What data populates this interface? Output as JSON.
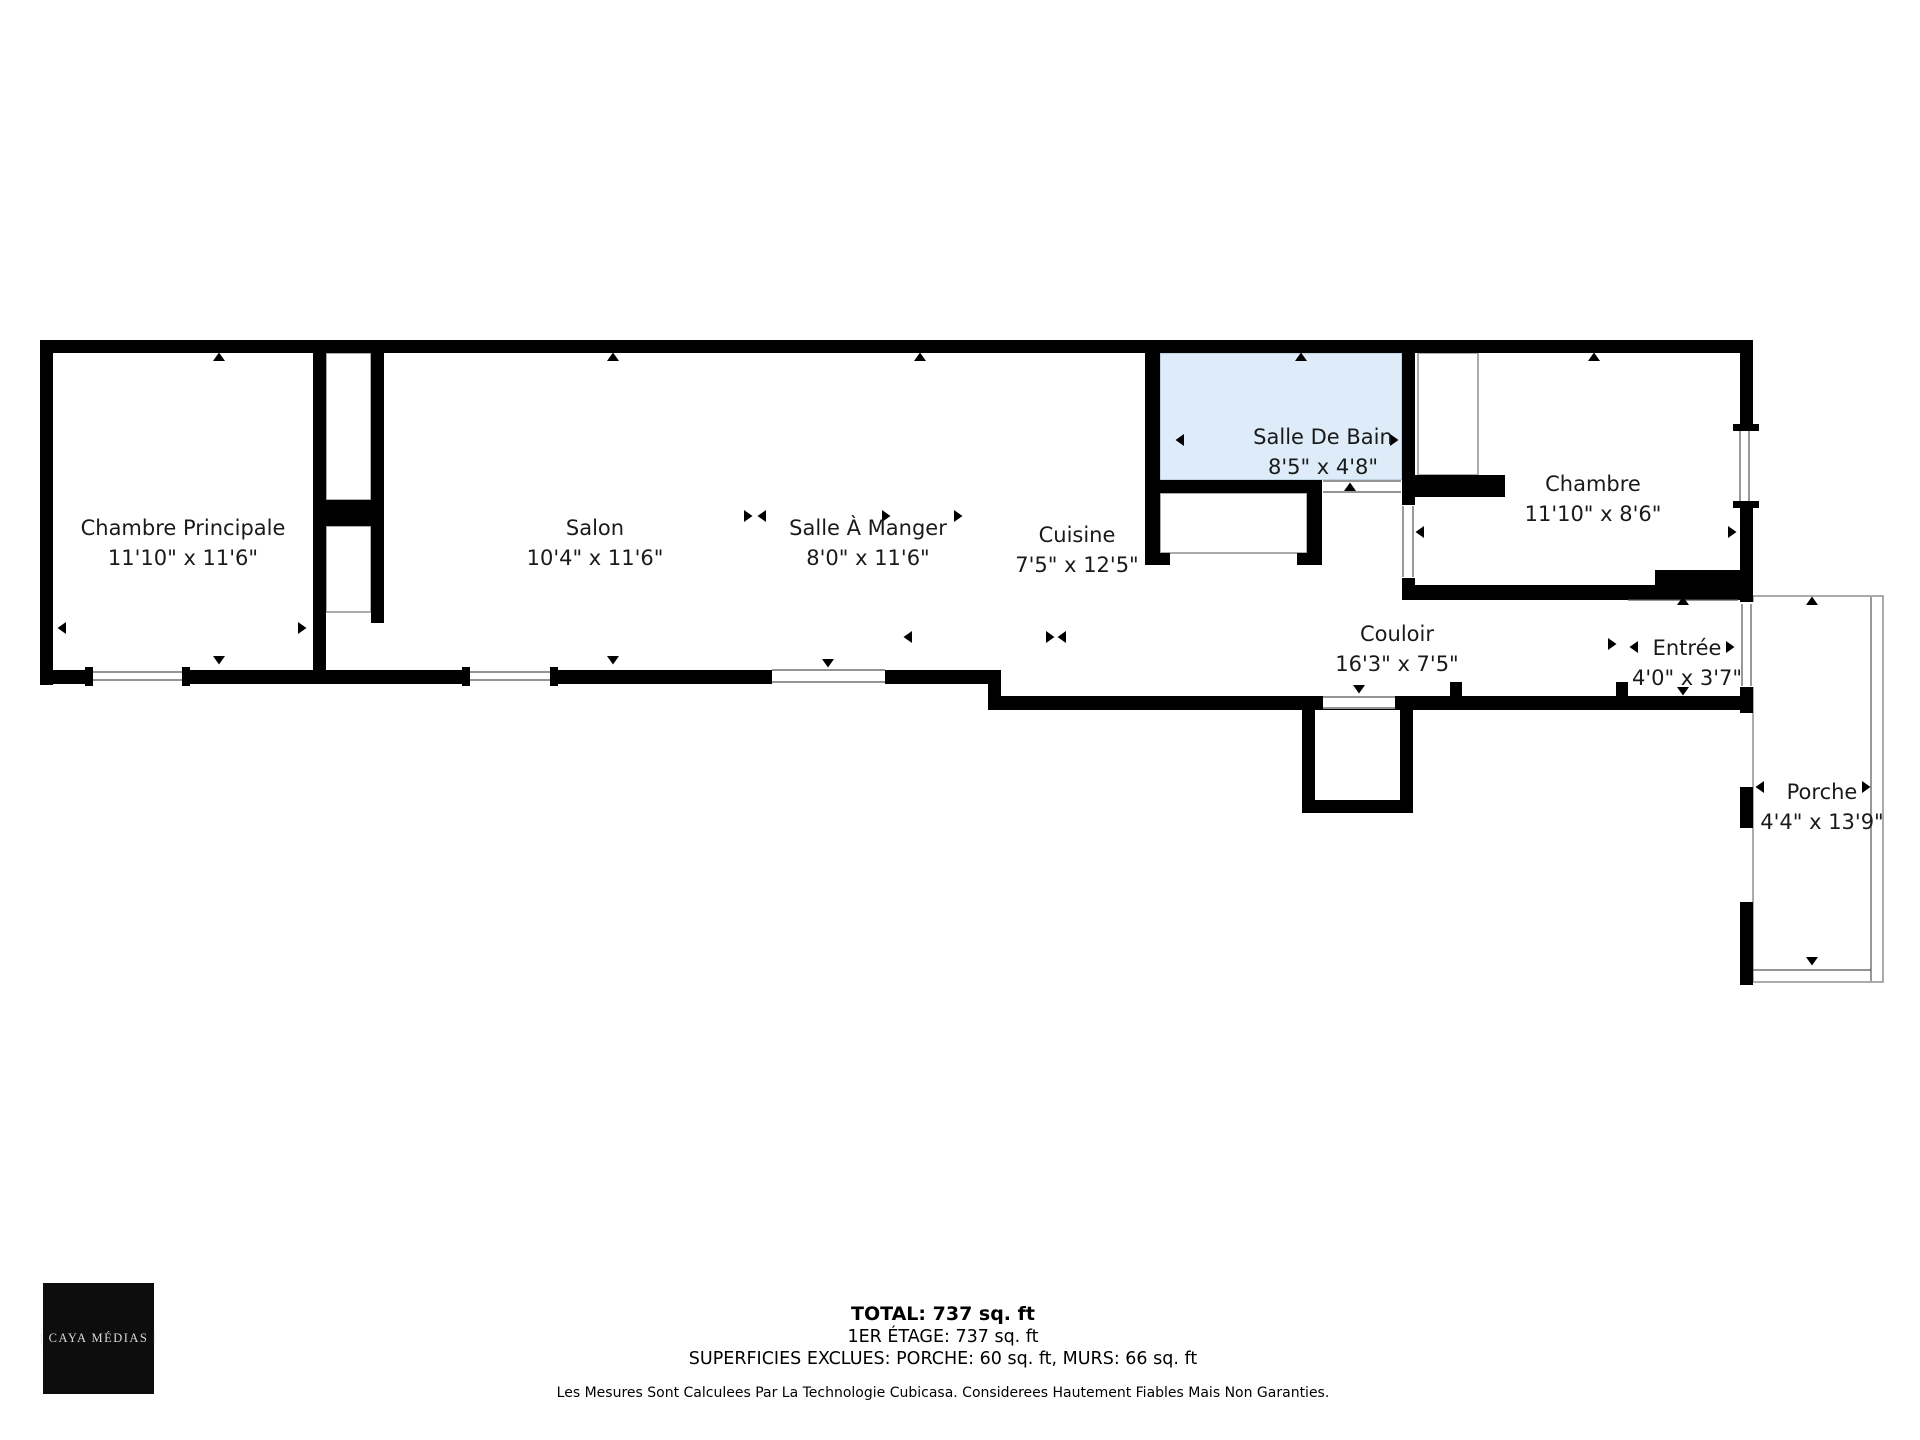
{
  "rooms": [
    {
      "name": "Chambre Principale",
      "dims": "11'10\" x 11'6\""
    },
    {
      "name": "Salon",
      "dims": "10'4\" x 11'6\""
    },
    {
      "name": "Salle À Manger",
      "dims": "8'0\" x 11'6\""
    },
    {
      "name": "Cuisine",
      "dims": "7'5\" x 12'5\""
    },
    {
      "name": "Salle De Bain",
      "dims": "8'5\" x 4'8\""
    },
    {
      "name": "Chambre",
      "dims": "11'10\" x 8'6\""
    },
    {
      "name": "Couloir",
      "dims": "16'3\" x 7'5\""
    },
    {
      "name": "Entrée",
      "dims": "4'0\" x 3'7\""
    },
    {
      "name": "Porche",
      "dims": "4'4\" x 13'9\""
    }
  ],
  "summary": {
    "total": "TOTAL: 737 sq. ft",
    "floor": "1ER ÉTAGE: 737 sq. ft",
    "excluded": "SUPERFICIES EXCLUES: PORCHE: 60 sq. ft, MURS: 66 sq. ft",
    "disclaimer": "Les Mesures Sont Calculees Par La Technologie Cubicasa. Considerees Hautement Fiables Mais Non Garanties."
  },
  "logo": {
    "text": "| CAYA MÉDIAS |"
  },
  "colors": {
    "wall": "#000000",
    "bathroom_fill": "#ddecf8",
    "outline": "#8f8f8f",
    "thin_line": "#555555",
    "text": "#1a1a1a"
  }
}
